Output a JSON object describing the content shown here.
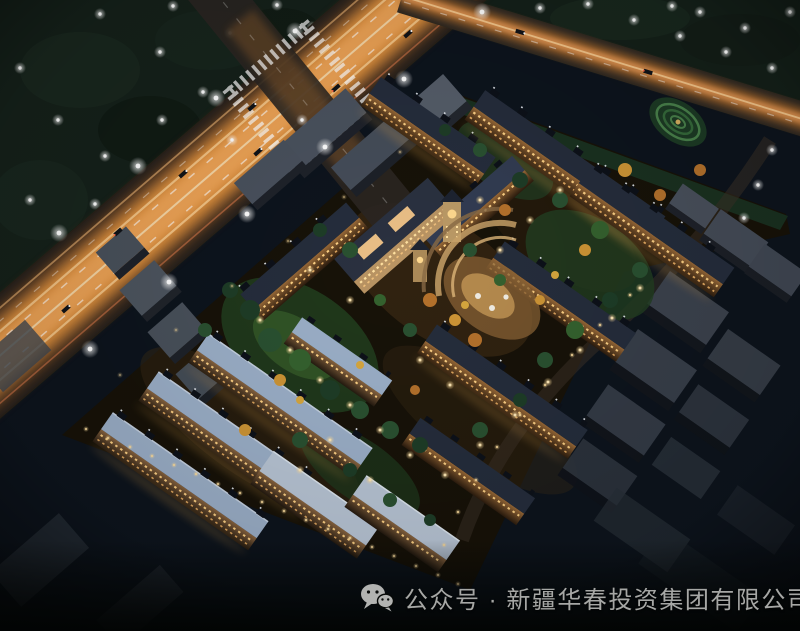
{
  "scene": {
    "description": "Aerial night rendering of a walled residential community with rows of low-rise apartment buildings, a lit central clubhouse plaza, courtyard gardens, a glowing multi-lane highway crossing at top left and perimeter roads with street lights; unlit gray city blocks surround the site.",
    "image_name": "aerial-night-rendering"
  },
  "caption": {
    "icon": "wechat-icon",
    "text": "公众号 · 新疆华春投资集团有限公司"
  },
  "colors": {
    "sky": "#0d141d",
    "canopy": "#15211a",
    "road_glow": "#e9973f",
    "light_trail": "#ffd9a0",
    "asphalt": "#35291f",
    "roof_dark": "#252d3c",
    "roof_blue": "#9cb0c9",
    "roof_pale": "#b9c6d6",
    "facade_warm": "#b9854a",
    "window_glow": "#ffd285",
    "tree_green": "#2a5031",
    "tree_autumn": "#c07a2e",
    "tree_gold": "#d8a43c",
    "ground_site": "#171208",
    "context_gray": "#4a525e",
    "wall_light": "#ffd98f",
    "wechat_gray": "#b2b3b1",
    "caption_text": "#a6a7a5"
  }
}
